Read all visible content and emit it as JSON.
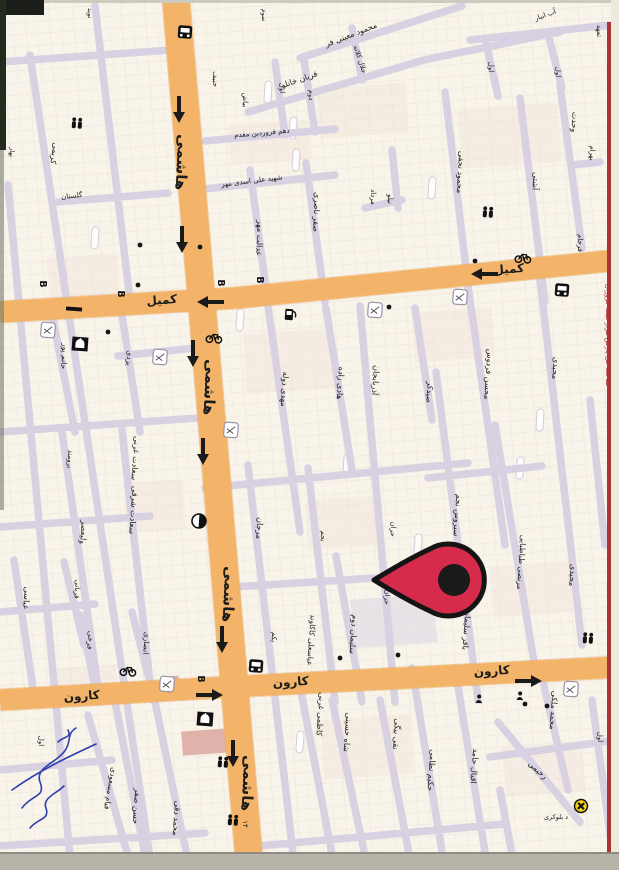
{
  "map": {
    "background": "#f8f4ea",
    "road_minor_color": "#d7d1e2",
    "road_major_color": "#f3b46a",
    "edge_line_color": "#a83434",
    "pin": {
      "x": 452,
      "y": 580,
      "color": "#d62b4b",
      "outline": "#141414"
    },
    "ad_text": "ساخت گل پارس هزار قیمه فروزان",
    "labels": [
      {
        "t": "هاشمی",
        "x": 177,
        "y": 162,
        "r": 93,
        "s": 15,
        "b": 1
      },
      {
        "t": "هاشمی",
        "x": 205,
        "y": 387,
        "r": 93,
        "s": 15,
        "b": 1
      },
      {
        "t": "هاشمی",
        "x": 224,
        "y": 594,
        "r": 93,
        "s": 15,
        "b": 1
      },
      {
        "t": "هاشمی",
        "x": 243,
        "y": 783,
        "r": 93,
        "s": 15,
        "b": 1
      },
      {
        "t": "کمیل",
        "x": 162,
        "y": 304,
        "r": -4,
        "s": 12,
        "b": 1
      },
      {
        "t": "کمیل",
        "x": 509,
        "y": 273,
        "r": -4,
        "s": 12,
        "b": 1
      },
      {
        "t": "کارون",
        "x": 82,
        "y": 700,
        "r": -4,
        "s": 12,
        "b": 1
      },
      {
        "t": "کارون",
        "x": 291,
        "y": 686,
        "r": -4,
        "s": 12,
        "b": 1
      },
      {
        "t": "کارون",
        "x": 492,
        "y": 675,
        "r": -4,
        "s": 12,
        "b": 1
      },
      {
        "t": "محمود معینی فر",
        "x": 352,
        "y": 37,
        "r": -21,
        "s": 8
      },
      {
        "t": "قربان خانلو",
        "x": 300,
        "y": 82,
        "r": -19,
        "s": 8
      },
      {
        "t": "جلال کلاته",
        "x": 358,
        "y": 60,
        "r": 72,
        "s": 7
      },
      {
        "t": "اول",
        "x": 280,
        "y": 88,
        "r": 90,
        "s": 7
      },
      {
        "t": "دوم",
        "x": 309,
        "y": 95,
        "r": 90,
        "s": 7
      },
      {
        "t": "بیاض",
        "x": 243,
        "y": 100,
        "r": 90,
        "s": 7
      },
      {
        "t": "حنیف",
        "x": 213,
        "y": 79,
        "r": 90,
        "s": 7
      },
      {
        "t": "نوید",
        "x": 88,
        "y": 13,
        "r": 90,
        "s": 6.5
      },
      {
        "t": "سوم",
        "x": 262,
        "y": 15,
        "r": 90,
        "s": 6.5
      },
      {
        "t": "دهم فروردین مقدم",
        "x": 262,
        "y": 135,
        "r": -5,
        "s": 7
      },
      {
        "t": "شهید علی اسدی مهر",
        "x": 252,
        "y": 183,
        "r": -7,
        "s": 7
      },
      {
        "t": "صفر ناصری",
        "x": 314,
        "y": 212,
        "r": 92,
        "s": 8
      },
      {
        "t": "عدالت مهر",
        "x": 257,
        "y": 238,
        "r": 92,
        "s": 8
      },
      {
        "t": "نیلو",
        "x": 388,
        "y": 199,
        "r": 90,
        "s": 7
      },
      {
        "t": "مرداد",
        "x": 371,
        "y": 197,
        "r": 90,
        "s": 7
      },
      {
        "t": "آب انبار",
        "x": 546,
        "y": 17,
        "r": -20,
        "s": 7
      },
      {
        "t": "اول",
        "x": 489,
        "y": 67,
        "r": 90,
        "s": 7
      },
      {
        "t": "اول",
        "x": 556,
        "y": 72,
        "r": 90,
        "s": 7
      },
      {
        "t": "تعهد",
        "x": 597,
        "y": 31,
        "r": 90,
        "s": 7
      },
      {
        "t": "محمود نجفی",
        "x": 458,
        "y": 172,
        "r": 93,
        "s": 8
      },
      {
        "t": "آشتی",
        "x": 533,
        "y": 181,
        "r": 93,
        "s": 8
      },
      {
        "t": "وحدت",
        "x": 572,
        "y": 122,
        "r": 93,
        "s": 8
      },
      {
        "t": "بهرام",
        "x": 590,
        "y": 153,
        "r": 90,
        "s": 7
      },
      {
        "t": "فرجام",
        "x": 578,
        "y": 243,
        "r": 90,
        "s": 7
      },
      {
        "t": "کریمی",
        "x": 52,
        "y": 153,
        "r": 98,
        "s": 8
      },
      {
        "t": "گلستان",
        "x": 72,
        "y": 198,
        "r": -6,
        "s": 7
      },
      {
        "t": "بهار",
        "x": 10,
        "y": 152,
        "r": 95,
        "s": 6.5
      },
      {
        "t": "حاتم پور",
        "x": 62,
        "y": 356,
        "r": 94,
        "s": 7.5
      },
      {
        "t": "یزدی",
        "x": 127,
        "y": 358,
        "r": 94,
        "s": 7.5
      },
      {
        "t": "مهدی دوله",
        "x": 282,
        "y": 389,
        "r": 94,
        "s": 8
      },
      {
        "t": "هادی زاده",
        "x": 338,
        "y": 383,
        "r": 94,
        "s": 8
      },
      {
        "t": "آذربایجان",
        "x": 373,
        "y": 380,
        "r": 94,
        "s": 8
      },
      {
        "t": "صیدکر",
        "x": 427,
        "y": 392,
        "r": 94,
        "s": 8
      },
      {
        "t": "محسن فردوس",
        "x": 486,
        "y": 374,
        "r": 94,
        "s": 8
      },
      {
        "t": "مجیدی",
        "x": 553,
        "y": 368,
        "r": 94,
        "s": 8
      },
      {
        "t": "مجیدی",
        "x": 570,
        "y": 575,
        "r": 94,
        "s": 8
      },
      {
        "t": "مرتضی طباطبایی",
        "x": 519,
        "y": 562,
        "r": 94,
        "s": 7.5
      },
      {
        "t": "سیروس نجم",
        "x": 455,
        "y": 515,
        "r": 94,
        "s": 8
      },
      {
        "t": "باقر سلیمان",
        "x": 464,
        "y": 630,
        "r": 94,
        "s": 8
      },
      {
        "t": "حران",
        "x": 391,
        "y": 529,
        "r": 94,
        "s": 7
      },
      {
        "t": "حران",
        "x": 385,
        "y": 597,
        "r": 94,
        "s": 7
      },
      {
        "t": "مرجان",
        "x": 257,
        "y": 528,
        "r": 94,
        "s": 8
      },
      {
        "t": "نجم",
        "x": 321,
        "y": 536,
        "r": 94,
        "s": 7
      },
      {
        "t": "سلیمان دوم",
        "x": 351,
        "y": 634,
        "r": 94,
        "s": 8
      },
      {
        "t": "عباسعلی کاکاوند",
        "x": 309,
        "y": 640,
        "r": 94,
        "s": 7.5
      },
      {
        "t": "یکم",
        "x": 272,
        "y": 637,
        "r": 94,
        "s": 7
      },
      {
        "t": "سعادت غربی",
        "x": 133,
        "y": 458,
        "r": 94,
        "s": 8
      },
      {
        "t": "سعادت شرقی",
        "x": 131,
        "y": 510,
        "r": 94,
        "s": 8
      },
      {
        "t": "ولیعصر",
        "x": 81,
        "y": 532,
        "r": 94,
        "s": 8
      },
      {
        "t": "برومند",
        "x": 68,
        "y": 459,
        "r": 94,
        "s": 7
      },
      {
        "t": "عباسی",
        "x": 24,
        "y": 598,
        "r": 94,
        "s": 8
      },
      {
        "t": "قربانی",
        "x": 75,
        "y": 589,
        "r": 94,
        "s": 7
      },
      {
        "t": "فرخی",
        "x": 88,
        "y": 640,
        "r": 94,
        "s": 7.5
      },
      {
        "t": "انصاری",
        "x": 144,
        "y": 643,
        "r": 94,
        "s": 7.5
      },
      {
        "t": "حسن صفر",
        "x": 134,
        "y": 806,
        "r": 94,
        "s": 8
      },
      {
        "t": "محمد دقی",
        "x": 174,
        "y": 818,
        "r": 94,
        "s": 8
      },
      {
        "t": "قیام مسعودی",
        "x": 108,
        "y": 788,
        "r": 100,
        "s": 7.5
      },
      {
        "t": "اول",
        "x": 39,
        "y": 741,
        "r": 90,
        "s": 7
      },
      {
        "t": "کاظمی غربی",
        "x": 318,
        "y": 714,
        "r": 94,
        "s": 8
      },
      {
        "t": "شاه حسینی",
        "x": 345,
        "y": 732,
        "r": 94,
        "s": 8
      },
      {
        "t": "نقی بیگی",
        "x": 394,
        "y": 734,
        "r": 94,
        "s": 8
      },
      {
        "t": "حکیم نظامی",
        "x": 429,
        "y": 770,
        "r": 94,
        "s": 8
      },
      {
        "t": "اقبال حامد",
        "x": 472,
        "y": 766,
        "r": 94,
        "s": 8
      },
      {
        "t": "رحیمی",
        "x": 536,
        "y": 772,
        "r": 42,
        "s": 8
      },
      {
        "t": "محمد ملکی",
        "x": 551,
        "y": 710,
        "r": 94,
        "s": 8
      },
      {
        "t": "اول",
        "x": 598,
        "y": 737,
        "r": 90,
        "s": 7
      },
      {
        "t": "د بلوکری",
        "x": 556,
        "y": 819,
        "r": 0,
        "s": 6.5
      },
      {
        "t": "۱۴",
        "x": 243,
        "y": 824,
        "r": 90,
        "s": 7
      }
    ],
    "letters": [
      {
        "t": "B",
        "x": 40,
        "y": 284
      },
      {
        "t": "B",
        "x": 118,
        "y": 294
      },
      {
        "t": "B",
        "x": 218,
        "y": 283
      },
      {
        "t": "B",
        "x": 257,
        "y": 280
      },
      {
        "t": "B",
        "x": 198,
        "y": 679
      }
    ],
    "arrows": [
      {
        "x": 179,
        "y": 108,
        "d": "down"
      },
      {
        "x": 182,
        "y": 238,
        "d": "down"
      },
      {
        "x": 193,
        "y": 352,
        "d": "down"
      },
      {
        "x": 203,
        "y": 450,
        "d": "down"
      },
      {
        "x": 222,
        "y": 638,
        "d": "down"
      },
      {
        "x": 233,
        "y": 752,
        "d": "down"
      },
      {
        "x": 212,
        "y": 302,
        "d": "left"
      },
      {
        "x": 486,
        "y": 274,
        "d": "left"
      },
      {
        "x": 208,
        "y": 695,
        "d": "right"
      },
      {
        "x": 527,
        "y": 681,
        "d": "right"
      }
    ],
    "icons": [
      {
        "k": "bus",
        "x": 185,
        "y": 32
      },
      {
        "k": "bus",
        "x": 562,
        "y": 290
      },
      {
        "k": "bus",
        "x": 256,
        "y": 666
      },
      {
        "k": "people",
        "x": 77,
        "y": 123
      },
      {
        "k": "people",
        "x": 488,
        "y": 212
      },
      {
        "k": "people",
        "x": 588,
        "y": 638
      },
      {
        "k": "people",
        "x": 223,
        "y": 762
      },
      {
        "k": "people",
        "x": 233,
        "y": 820
      },
      {
        "k": "mosque",
        "x": 80,
        "y": 344
      },
      {
        "k": "mosque",
        "x": 205,
        "y": 719
      },
      {
        "k": "bike",
        "x": 214,
        "y": 338
      },
      {
        "k": "bike",
        "x": 523,
        "y": 258
      },
      {
        "k": "bike",
        "x": 128,
        "y": 671
      },
      {
        "k": "pie",
        "x": 199,
        "y": 521
      },
      {
        "k": "pump",
        "x": 289,
        "y": 315
      },
      {
        "k": "badge",
        "x": 375,
        "y": 310
      },
      {
        "k": "badge",
        "x": 460,
        "y": 297
      },
      {
        "k": "badge",
        "x": 160,
        "y": 357
      },
      {
        "k": "badge",
        "x": 48,
        "y": 330
      },
      {
        "k": "badge",
        "x": 167,
        "y": 684
      },
      {
        "k": "badge",
        "x": 571,
        "y": 689
      },
      {
        "k": "badge",
        "x": 231,
        "y": 430
      },
      {
        "k": "blob",
        "x": 479,
        "y": 699
      },
      {
        "k": "blob",
        "x": 520,
        "y": 696
      },
      {
        "k": "xmark",
        "x": 581,
        "y": 806
      },
      {
        "k": "dash",
        "x": 74,
        "y": 309
      }
    ],
    "dots": [
      [
        140,
        245
      ],
      [
        200,
        247
      ],
      [
        108,
        332
      ],
      [
        138,
        285
      ],
      [
        389,
        307
      ],
      [
        475,
        261
      ],
      [
        398,
        655
      ],
      [
        525,
        704
      ],
      [
        340,
        658
      ],
      [
        547,
        706
      ]
    ],
    "pills": [
      [
        293,
        128
      ],
      [
        296,
        160
      ],
      [
        240,
        320
      ],
      [
        347,
        465
      ],
      [
        232,
        558
      ],
      [
        268,
        92
      ],
      [
        432,
        188
      ],
      [
        520,
        468
      ],
      [
        300,
        742
      ],
      [
        95,
        238
      ],
      [
        418,
        545
      ],
      [
        540,
        420
      ]
    ]
  }
}
